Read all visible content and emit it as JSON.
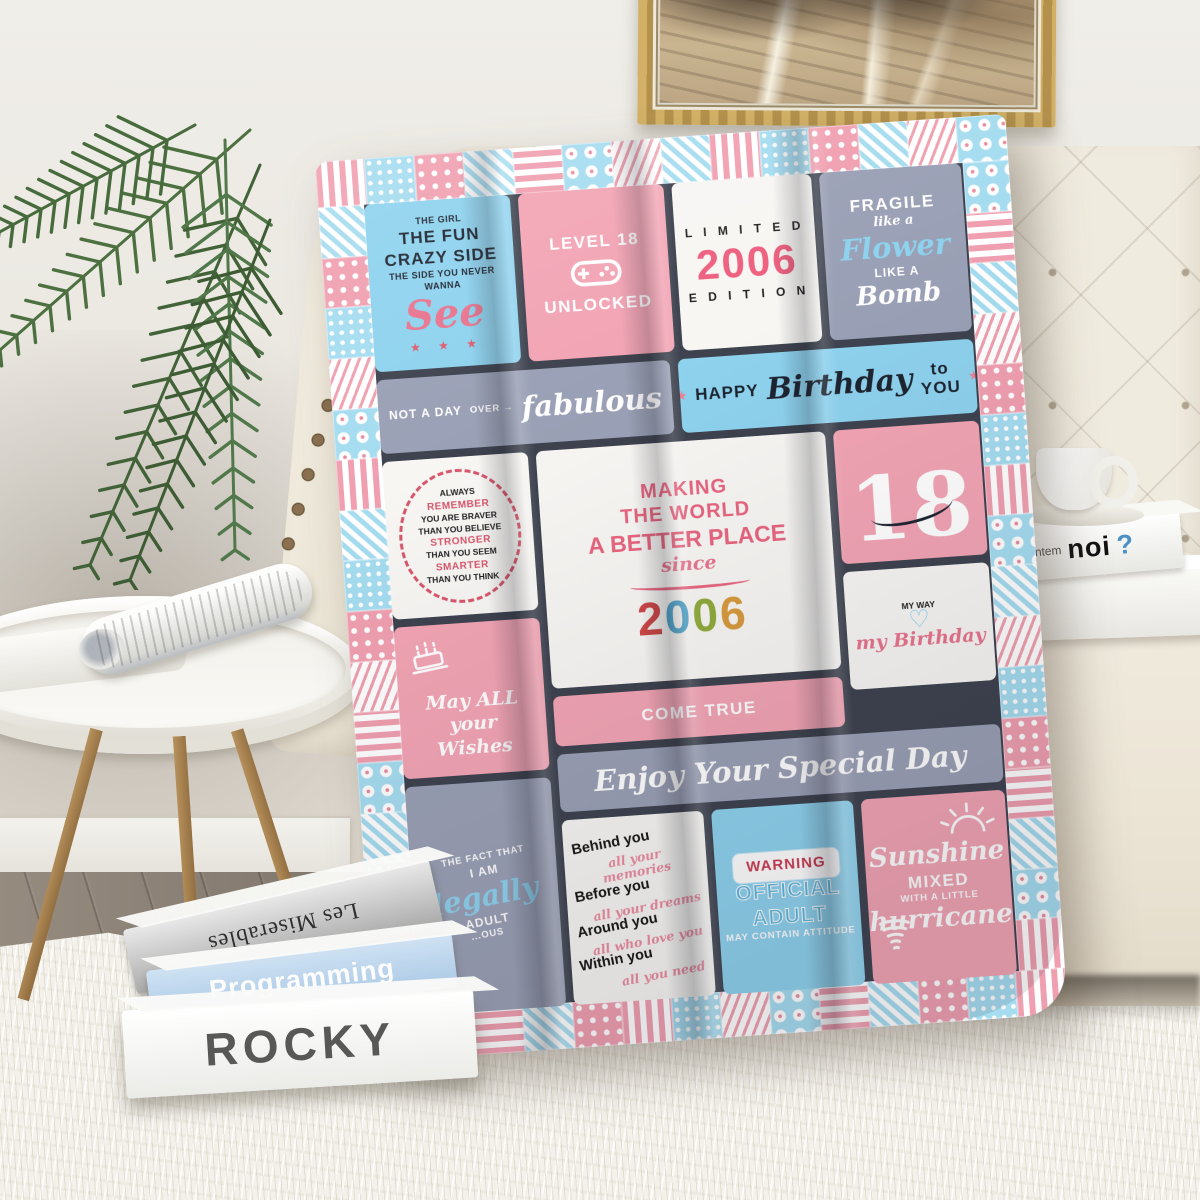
{
  "scene": {
    "description": "Product lifestyle photo: a pink/blue patchwork 18th-birthday throw blanket draped over a cream tufted sofa, with a gold-framed abstract painting, palm plant, white round side table with a rolled magazine, a coffee cup on white books, stacked books on a white shag rug",
    "colors": {
      "wall": "#e9e5de",
      "rug": "#f3f1ea",
      "sofa": "#f0ebdf",
      "blanket_border": "#3d424e",
      "accent_pink": "#f2a4b4",
      "accent_blue": "#8ed2ee",
      "accent_gray": "#9aa0b5",
      "panel_white": "#f7f6f3"
    }
  },
  "books_floor": [
    {
      "title": "Les Miserables"
    },
    {
      "title": "Programming"
    },
    {
      "title": "ROCKY"
    }
  ],
  "sofa_books": {
    "spine_small": "ntem",
    "spine_title": "noi",
    "spine_mark": "?"
  },
  "blanket": {
    "border_patterns": {
      "top": [
        "stripe-pink-v",
        "dot-blue",
        "heart-pink",
        "stripe-blue-d",
        "stripe-pink-h",
        "flower-blue",
        "wave-pink",
        "stripe-blue-d",
        "stripe-pink-v",
        "dot-blue",
        "heart-pink",
        "stripe-blue-d",
        "wave-pink",
        "flower-blue"
      ],
      "bottom": [
        "wave-pink",
        "flower-blue",
        "stripe-pink-h",
        "stripe-blue-d",
        "heart-pink",
        "stripe-pink-v",
        "dot-blue",
        "wave-pink",
        "flower-blue",
        "stripe-pink-h",
        "stripe-blue-d",
        "heart-pink",
        "dot-blue",
        "stripe-pink-v"
      ],
      "left": [
        "stripe-blue-d",
        "heart-pink",
        "dot-blue",
        "wave-pink",
        "flower-blue",
        "stripe-pink-v",
        "stripe-blue-d",
        "dot-blue",
        "heart-pink",
        "wave-pink",
        "stripe-pink-h",
        "flower-blue",
        "stripe-blue-d",
        "dot-blue",
        "heart-pink",
        "stripe-pink-v"
      ],
      "right": [
        "flower-blue",
        "stripe-pink-h",
        "stripe-blue-d",
        "wave-pink",
        "heart-pink",
        "dot-blue",
        "stripe-pink-v",
        "flower-blue",
        "stripe-blue-d",
        "wave-pink",
        "dot-blue",
        "heart-pink",
        "stripe-pink-h",
        "stripe-blue-d",
        "flower-blue",
        "stripe-pink-v"
      ]
    },
    "panels": [
      {
        "id": "crazy-side",
        "bg": "blue",
        "lines": [
          {
            "t": "THE GIRL",
            "s": "caps-xs"
          },
          {
            "t": "THE FUN",
            "s": "caps-md"
          },
          {
            "t": "CRAZY SIDE",
            "s": "caps-md"
          },
          {
            "t": "THE SIDE YOU NEVER",
            "s": "caps-xs"
          },
          {
            "t": "WANNA",
            "s": "caps-xs"
          },
          {
            "t": "See",
            "s": "script script-pink-xl"
          },
          {
            "t": "★ ★ ★",
            "s": "stars-red"
          }
        ]
      },
      {
        "id": "level-unlocked",
        "bg": "pink",
        "lines": [
          {
            "t": "LEVEL 18",
            "s": "caps-wht-md"
          },
          {
            "icon": "game-controller"
          },
          {
            "t": "UNLOCKED",
            "s": "caps-wht-md"
          }
        ]
      },
      {
        "id": "limited-edition",
        "bg": "white",
        "lines": [
          {
            "t": "L I M I T E D",
            "s": "caps-blk-sp"
          },
          {
            "t": "2006",
            "s": "num-pink-xl"
          },
          {
            "t": "E D I T I O N",
            "s": "caps-blk-sp"
          }
        ]
      },
      {
        "id": "fragile-bomb",
        "bg": "gray",
        "lines": [
          {
            "t": "FRAGILE",
            "s": "caps-wht-md"
          },
          {
            "t": "like a",
            "s": "script script-wht-sm"
          },
          {
            "t": "Flower",
            "s": "script script-blue-lg"
          },
          {
            "t": "LIKE A",
            "s": "caps-wht-sm"
          },
          {
            "t": "Bomb",
            "s": "script script-wht-lg"
          }
        ]
      },
      {
        "id": "not-a-day-over",
        "bg": "gray",
        "band": true,
        "lines": [
          {
            "t": "NOT A DAY",
            "s": "caps-wht-sm"
          },
          {
            "t": "OVER →",
            "s": "caps-wht-xs"
          },
          {
            "t": "fabulous",
            "s": "script script-wht-xl"
          }
        ]
      },
      {
        "id": "happy-birthday",
        "bg": "blue",
        "band": true,
        "lines": [
          {
            "t": "★",
            "s": "star-pink"
          },
          {
            "t": "HAPPY",
            "s": "caps-md"
          },
          {
            "t": "Birthday",
            "s": "script script-blk-lg"
          },
          {
            "t": "to YOU",
            "s": "caps-md"
          },
          {
            "t": "★",
            "s": "star-pink"
          }
        ]
      },
      {
        "id": "always-remember",
        "bg": "white",
        "lines": [
          {
            "t": "ALWAYS",
            "s": "caps-blk-2xs"
          },
          {
            "t": "REMEMBER",
            "s": "caps-red-2xs"
          },
          {
            "t": "YOU ARE BRAVER",
            "s": "caps-blk-2xs"
          },
          {
            "t": "THAN YOU BELIEVE",
            "s": "caps-blk-2xs"
          },
          {
            "t": "STRONGER",
            "s": "caps-red-2xs"
          },
          {
            "t": "THAN YOU SEEM",
            "s": "caps-blk-2xs"
          },
          {
            "t": "SMARTER",
            "s": "caps-red-2xs"
          },
          {
            "t": "THAN YOU THINK",
            "s": "caps-blk-2xs"
          }
        ]
      },
      {
        "id": "making-world",
        "bg": "white",
        "lines": [
          {
            "t": "MAKING",
            "s": "caps-pink-lg"
          },
          {
            "t": "THE WORLD",
            "s": "caps-pink-lg"
          },
          {
            "t": "A BETTER PLACE",
            "s": "caps-pink-xl"
          },
          {
            "t": "since",
            "s": "script script-pink-md"
          },
          {
            "squiggle": true
          },
          {
            "t": "2006",
            "s": "digits-multi"
          }
        ]
      },
      {
        "id": "eighteen",
        "bg": "pink",
        "lines": [
          {
            "t": "18",
            "s": "num-wht-huge"
          },
          {
            "flourish": true
          }
        ]
      },
      {
        "id": "my-way-birthday",
        "bg": "white",
        "lines": [
          {
            "t": "MY WAY",
            "s": "caps-blk-2xs"
          },
          {
            "t": "♡",
            "s": "heart-blue"
          },
          {
            "t": "my Birthday",
            "s": "script script-pink-md"
          }
        ]
      },
      {
        "id": "wishes",
        "bg": "pink",
        "lines": [
          {
            "icon": "cake"
          },
          {
            "t": "May ALL",
            "s": "script script-wht-md"
          },
          {
            "t": "your",
            "s": "script script-wht-md"
          },
          {
            "t": "Wishes",
            "s": "script script-wht-md"
          }
        ]
      },
      {
        "id": "come-true",
        "bg": "pink",
        "band": true,
        "lines": [
          {
            "t": "COME TRUE",
            "s": "caps-wht-md"
          }
        ]
      },
      {
        "id": "legally-adult",
        "bg": "gray",
        "lines": [
          {
            "t": "THE FACT THAT",
            "s": "caps-wht-xs"
          },
          {
            "t": "I AM",
            "s": "caps-wht-sm"
          },
          {
            "t": "legally",
            "s": "script script-blue-lg"
          },
          {
            "t": "ADULT",
            "s": "caps-wht-sm"
          },
          {
            "t": "...OUS",
            "s": "caps-wht-xs"
          }
        ]
      },
      {
        "id": "enjoy-day",
        "bg": "gray",
        "band": true,
        "lines": [
          {
            "t": "Enjoy Your Special Day",
            "s": "script script-wht-xl"
          }
        ]
      },
      {
        "id": "behind-you",
        "bg": "white",
        "lines": [
          {
            "t": "Behind you",
            "s": "caps-blk-bold"
          },
          {
            "t": "all your memories",
            "s": "script script-pink-sm"
          },
          {
            "t": "Before you",
            "s": "caps-blk-bold"
          },
          {
            "t": "all your dreams",
            "s": "script script-pink-sm"
          },
          {
            "t": "Around you",
            "s": "caps-blk-bold"
          },
          {
            "t": "all who love you",
            "s": "script script-pink-sm"
          },
          {
            "t": "Within you",
            "s": "caps-blk-bold"
          },
          {
            "t": "all you need",
            "s": "script script-pink-sm"
          }
        ]
      },
      {
        "id": "warning-adult",
        "bg": "blue",
        "lines": [
          {
            "t": "WARNING",
            "s": "warning-box"
          },
          {
            "t": "OFFICIAL",
            "s": "caps-blue-lg"
          },
          {
            "t": "ADULT",
            "s": "caps-blue-lg"
          },
          {
            "t": "MAY CONTAIN ATTITUDE",
            "s": "caps-wht-xs"
          }
        ]
      },
      {
        "id": "sunshine-hurricane",
        "bg": "pink",
        "lines": [
          {
            "icon": "sun"
          },
          {
            "t": "Sunshine",
            "s": "script script-wht-lg"
          },
          {
            "t": "MIXED",
            "s": "caps-wht-md"
          },
          {
            "t": "WITH A LITTLE",
            "s": "caps-wht-xs"
          },
          {
            "t": "hurricane",
            "s": "script script-wht-lg"
          },
          {
            "icon": "tornado"
          }
        ]
      }
    ]
  }
}
